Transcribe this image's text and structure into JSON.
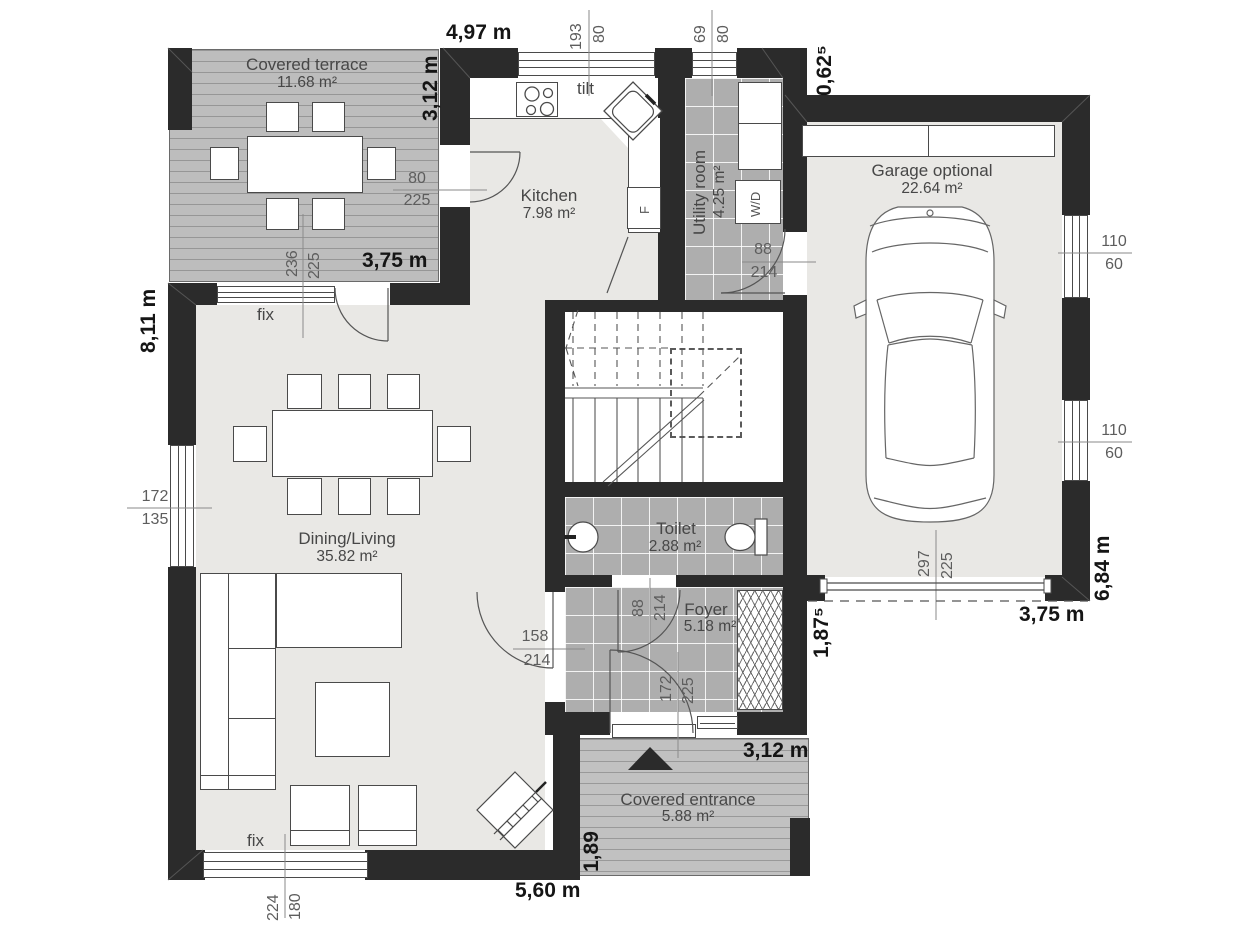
{
  "plan": {
    "rooms": [
      {
        "name": "Covered terrace",
        "area": "11.68 m²"
      },
      {
        "name": "Kitchen",
        "area": "7.98 m²"
      },
      {
        "name": "Utility room",
        "area": "4.25 m²"
      },
      {
        "name": "Garage optional",
        "area": "22.64 m²"
      },
      {
        "name": "Dining/Living",
        "area": "35.82 m²"
      },
      {
        "name": "Toilet",
        "area": "2.88 m²"
      },
      {
        "name": "Foyer",
        "area": "5.18 m²"
      },
      {
        "name": "Covered entrance",
        "area": "5.88 m²"
      }
    ],
    "labels": {
      "fix_top": "fix",
      "fix_bottom": "fix",
      "tilt": "tilt",
      "washer_dryer": "W/D",
      "fridge": "F"
    },
    "overall_dims": {
      "top_width": "4,97 m",
      "terrace_depth": "3,12 m",
      "terrace_width": "3,75 m",
      "left_height": "8,11 m",
      "garage_offset": "0,62⁵",
      "garage_depth": "6,84 m",
      "garage_width": "3,75 m",
      "foyer_offset": "1,87⁵",
      "entrance_width": "3,12 m",
      "entrance_depth": "1,89",
      "bottom_width": "5,60 m"
    },
    "opening_dims": {
      "kitchen_window": {
        "w": "193",
        "h": "80"
      },
      "utility_window": {
        "w": "69",
        "h": "80"
      },
      "terrace_kitchen_door": {
        "w": "80",
        "h": "225"
      },
      "terrace_living_door": {
        "w": "236",
        "h": "225"
      },
      "utility_garage_door": {
        "w": "88",
        "h": "214"
      },
      "garage_window_1": {
        "w": "110",
        "h": "60"
      },
      "garage_window_2": {
        "w": "110",
        "h": "60"
      },
      "garage_door": {
        "w": "297",
        "h": "225"
      },
      "living_window_left": {
        "w": "172",
        "h": "135"
      },
      "toilet_door": {
        "w": "88",
        "h": "214"
      },
      "living_foyer_door": {
        "w": "158",
        "h": "214"
      },
      "entrance_door": {
        "w": "172",
        "h": "225"
      },
      "living_window_bottom": {
        "w": "224",
        "h": "180"
      }
    },
    "colors": {
      "wall": "#2b2b2b",
      "floor_light": "#e9e8e5",
      "tile_gray": "#aeaeae",
      "deck_gray": "#c1c1c1",
      "line": "#4a4a4a",
      "dim_text": "#5d5d5d",
      "meter_text": "#151515"
    }
  }
}
